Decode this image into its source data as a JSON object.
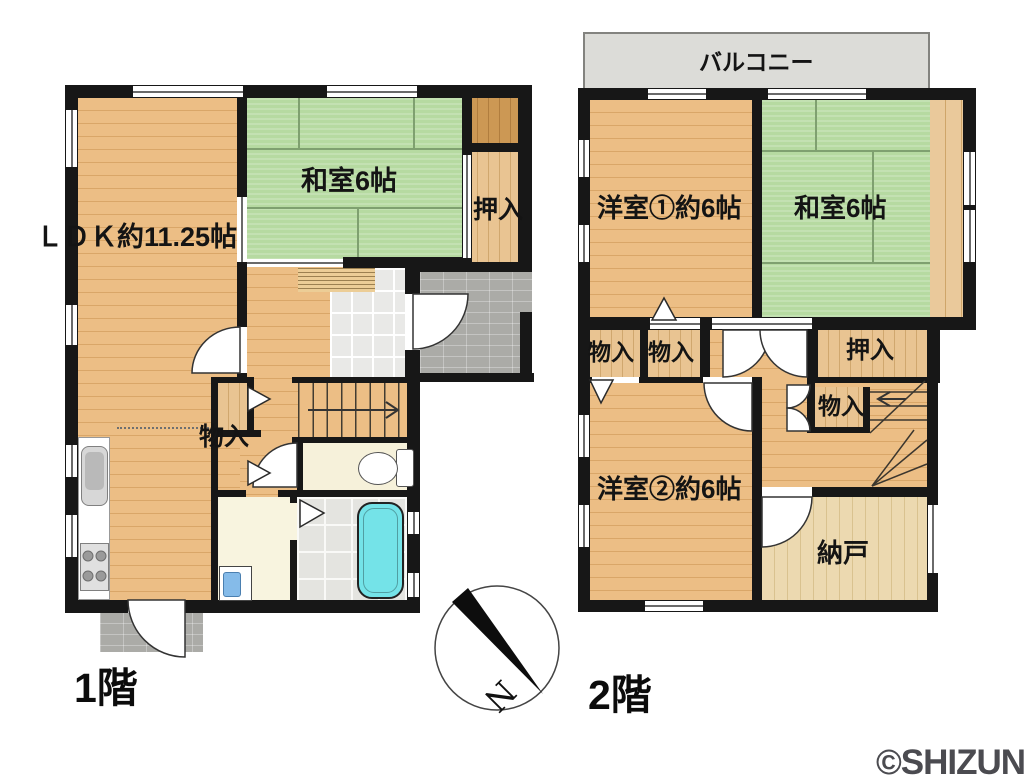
{
  "floor1": {
    "title": "1階",
    "rooms": {
      "ldk": "ＬＤＫ約11.25帖",
      "washitsu": "和室6帖",
      "oshiire": "押入",
      "monoire": "物入"
    }
  },
  "floor2": {
    "title": "2階",
    "rooms": {
      "balcony": "バルコニー",
      "yoshitsu1": "洋室①約6帖",
      "washitsu": "和室6帖",
      "monoire_a": "物入",
      "monoire_b": "物入",
      "oshiire": "押入",
      "monoire_c": "物入",
      "yoshitsu2": "洋室②約6帖",
      "nando": "納戸"
    }
  },
  "compass": {
    "north": "N"
  },
  "watermark": "©SHIZUNAVI",
  "colors": {
    "wall": "#171717",
    "wood": "#ecbe85",
    "tatami": "#b6daa1",
    "balcony": "#dcdcd8",
    "bathtub": "#74e3e8"
  }
}
